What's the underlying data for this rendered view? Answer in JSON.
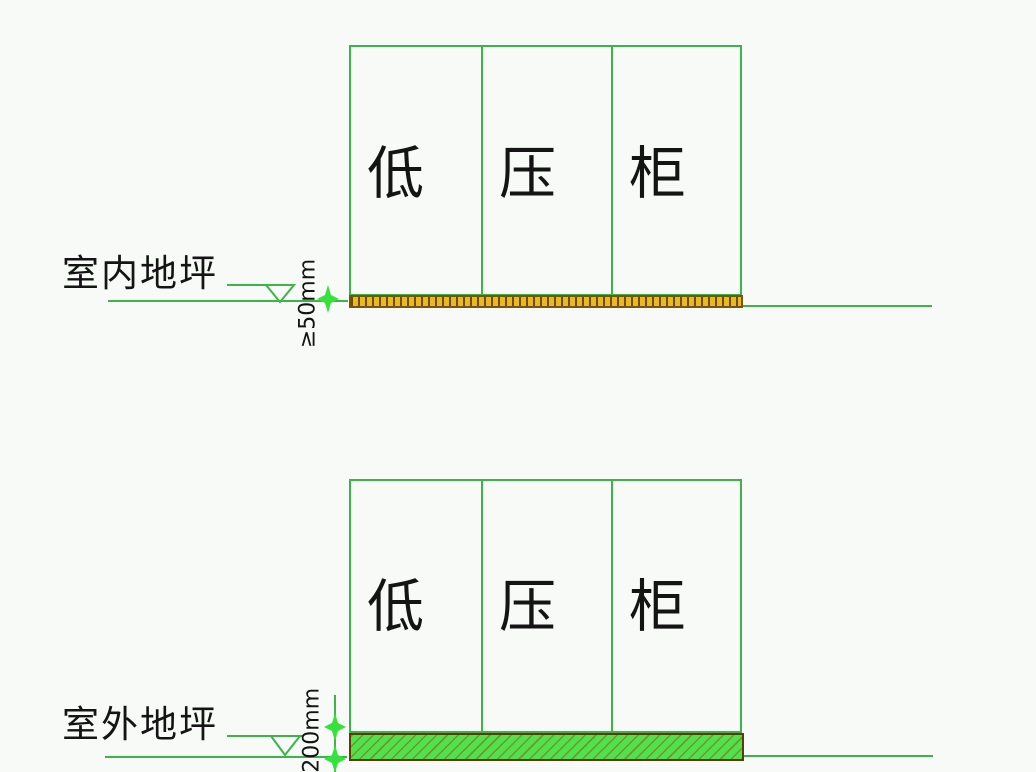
{
  "colors": {
    "background": "#f7faf7",
    "line_green": "#3cb44a",
    "marker_green": "#35e23b",
    "pad_top_fill": "#e9b91f",
    "pad_top_hatch": "#6b4c00",
    "pad_top_border": "#7b5302",
    "pad_bottom_fill": "#53e04e",
    "pad_bottom_hatch": "#7a640a",
    "pad_bottom_border": "#5d3a08",
    "text": "#141414"
  },
  "icons": {
    "level_triangle": "▽",
    "dimension_marker": "✦"
  },
  "top_diagram": {
    "floor_label": "室内地坪",
    "dimension_label": "≥50mm",
    "cabinet_sections": [
      "低",
      "压",
      "柜"
    ]
  },
  "bottom_diagram": {
    "floor_label": "室外地坪",
    "dimension_label": "≥200mm",
    "cabinet_sections": [
      "低",
      "压",
      "柜"
    ]
  }
}
